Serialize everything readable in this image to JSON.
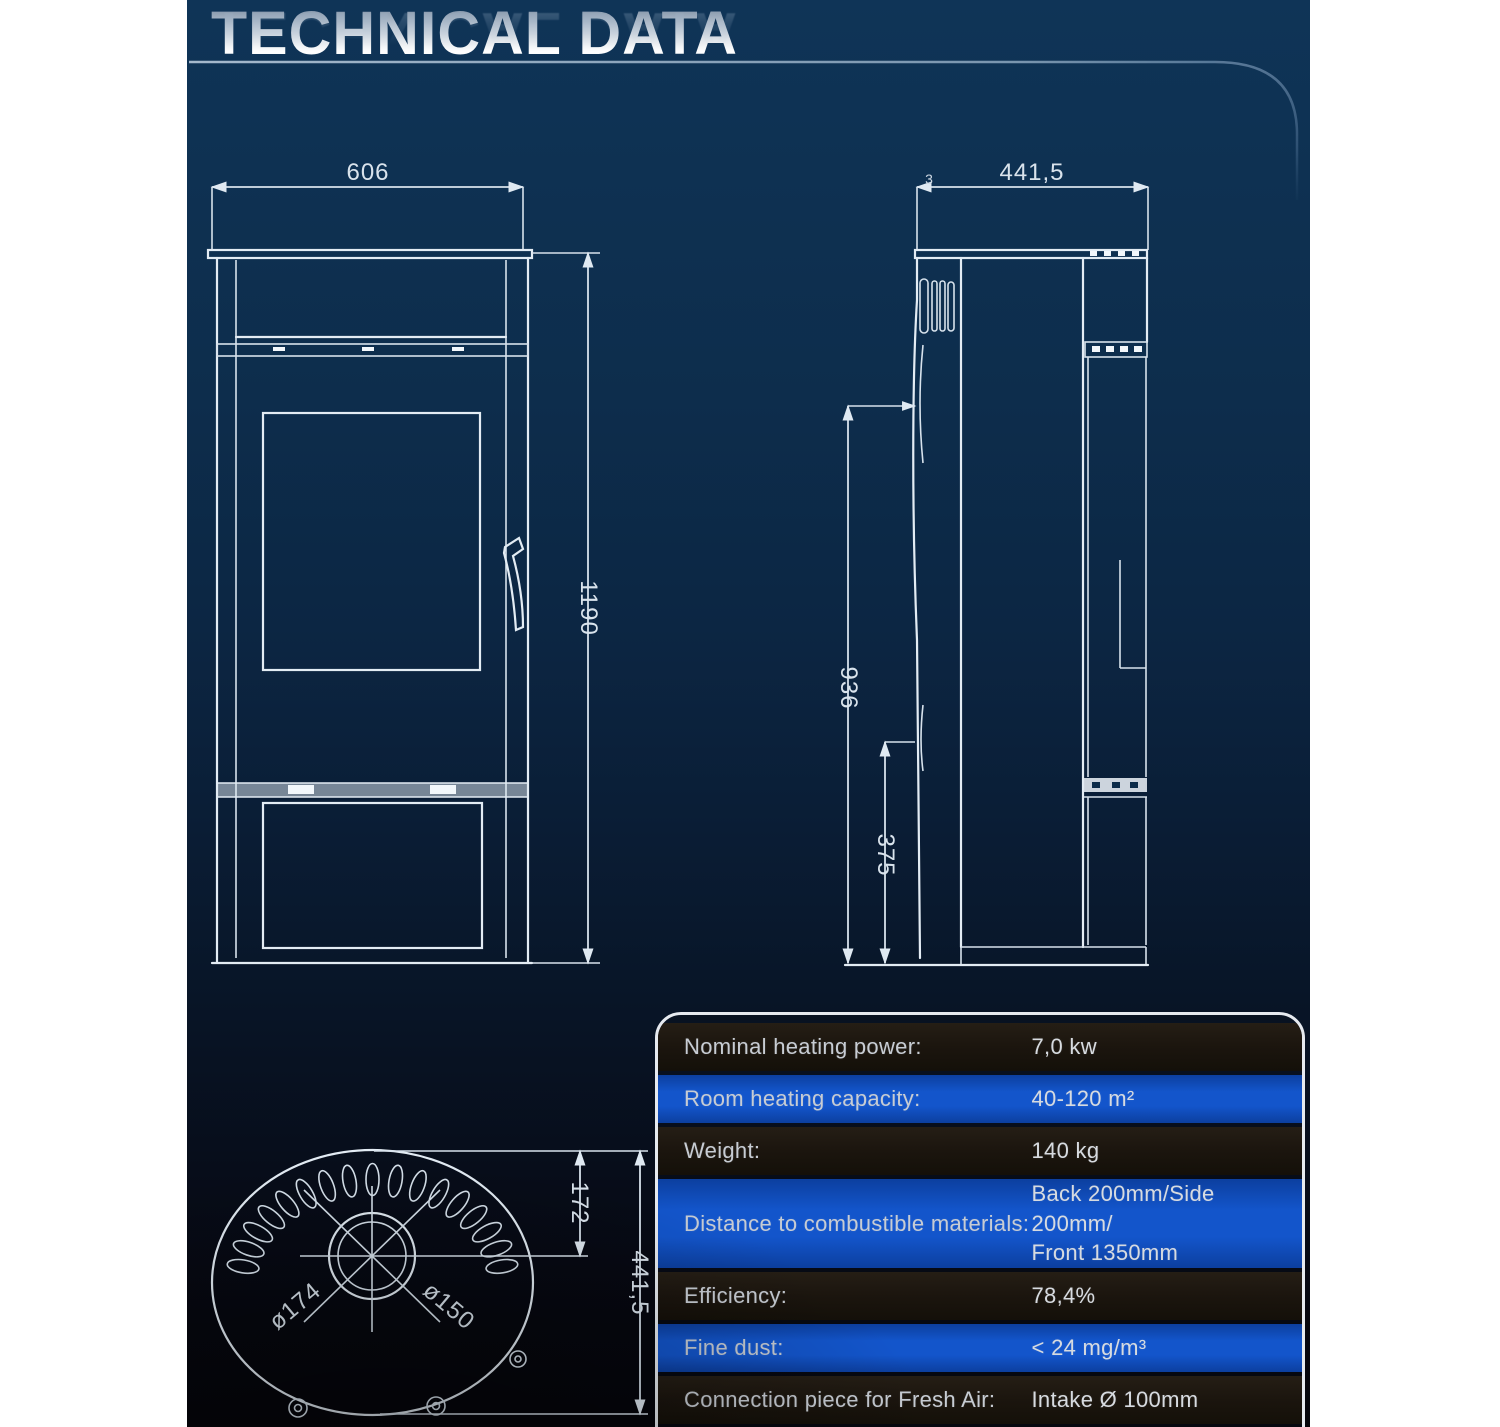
{
  "header": {
    "title": "TECHNICAL DATA"
  },
  "drawings": {
    "front": {
      "width_label": "606",
      "height_label": "1190"
    },
    "side": {
      "depth_label": "441,5",
      "lip_label": "3",
      "upper_height_label": "936",
      "base_height_label": "375"
    },
    "top": {
      "flue_outer_label": "ø174",
      "flue_inner_label": "ø150",
      "center_offset_label": "172",
      "depth_label": "441,5"
    }
  },
  "table": {
    "rows": [
      {
        "label": "Nominal heating power:",
        "value": "7,0 kw",
        "style": "dark"
      },
      {
        "label": "Room heating capacity:",
        "value": "40-120 m²",
        "style": "blue"
      },
      {
        "label": "Weight:",
        "value": "140 kg",
        "style": "dark"
      },
      {
        "label": "Distance to combustible materials:",
        "value": "Back 200mm/Side 200mm/",
        "value2": "Front 1350mm",
        "style": "blue"
      },
      {
        "label": "Efficiency:",
        "value": "78,4%",
        "style": "dark"
      },
      {
        "label": "Fine dust:",
        "value": "< 24 mg/m³",
        "style": "blue"
      },
      {
        "label": "Connection piece for Fresh Air:",
        "value": "Intake Ø 100mm",
        "style": "dark"
      }
    ]
  },
  "colors": {
    "panel_navy": "#0e3152",
    "row_dark": "#1b150e",
    "row_blue": "#1355cb",
    "line": "#e3ecf4",
    "page_background": "#ffffff"
  }
}
